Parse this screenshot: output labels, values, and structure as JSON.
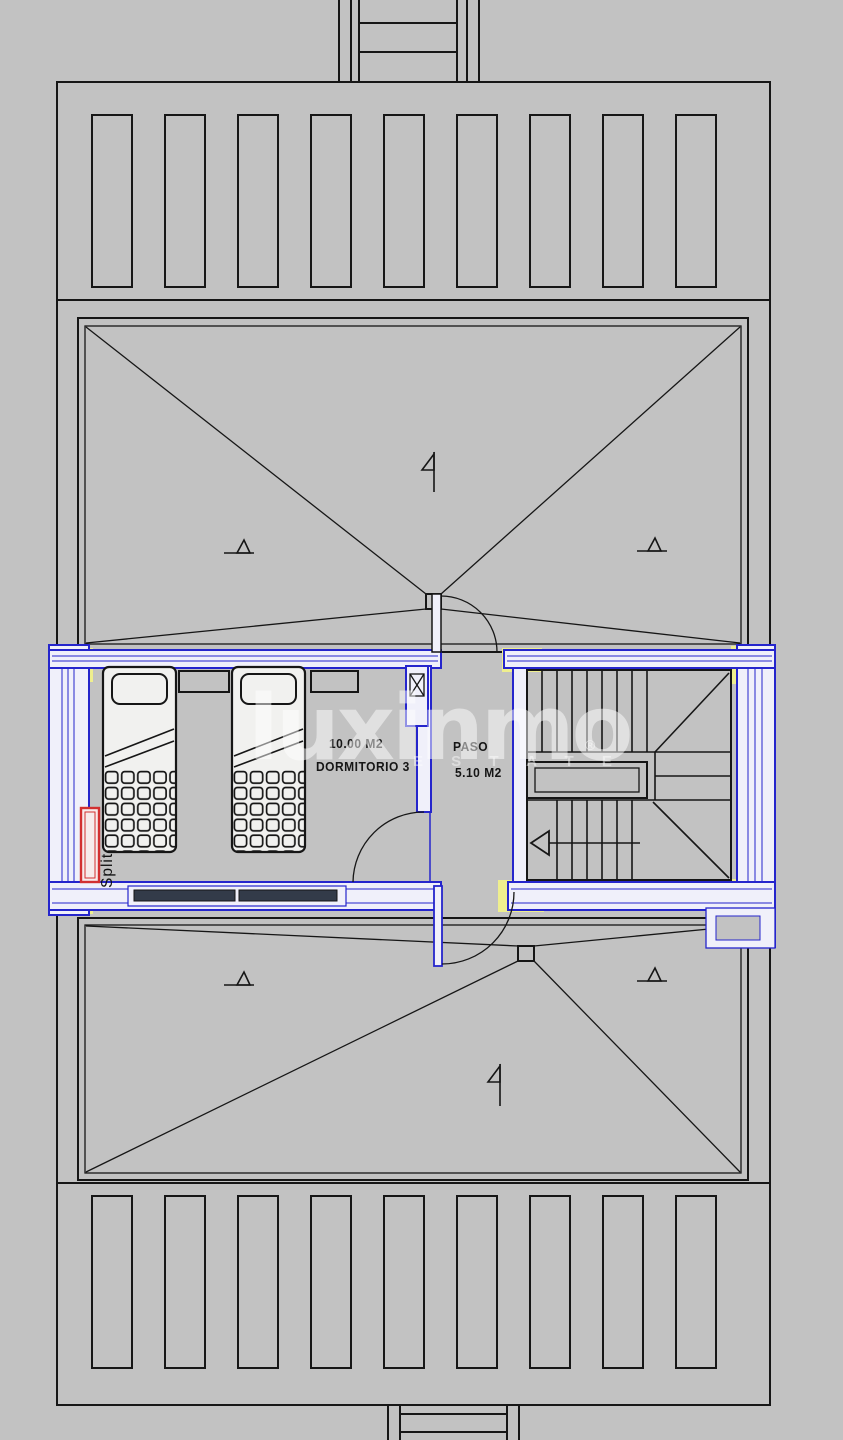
{
  "document": {
    "type": "architectural floor plan",
    "level": "attic / roof plan"
  },
  "rooms": [
    {
      "name": "DORMITORIO 3",
      "area": "10.00 M2"
    },
    {
      "name": "PASO",
      "area": "5.10 M2"
    }
  ],
  "equipment": {
    "split_label": "Split"
  },
  "watermark": {
    "brand": "luxinmo",
    "registered_mark": "®",
    "tagline": "E S T A T E"
  },
  "colors": {
    "background": "#c2c2c2",
    "line": "#161616",
    "wall_blue": "#2525cc",
    "wall_fill": "#f0f0fa",
    "column_yellow": "#efef8e",
    "split_red": "#d23030",
    "window_glass": "#333b49",
    "watermark_white": "#ffffff"
  }
}
